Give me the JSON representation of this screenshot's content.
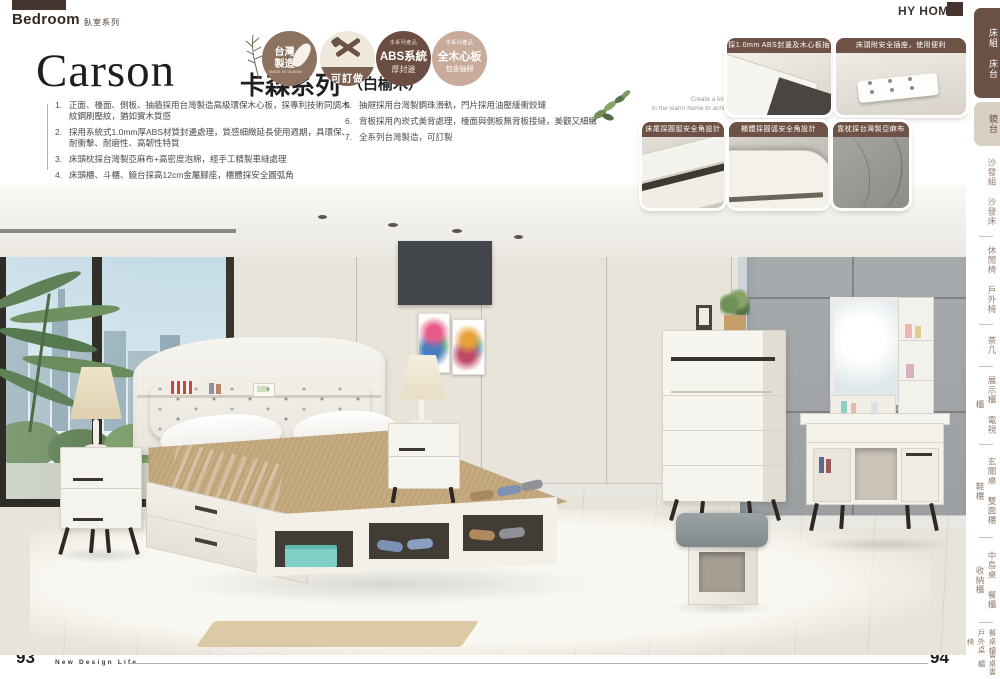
{
  "header": {
    "section_en": "Bedroom",
    "section_zh": "臥室系列",
    "brand": "HY HOME"
  },
  "series": {
    "name_en": "Carson",
    "name_zh": "卡森系列",
    "wood": "（白榆木）"
  },
  "badges": {
    "made_in_taiwan": {
      "line1": "台灣",
      "line2": "製造",
      "sub": "MADE IN TAIWAN"
    },
    "customizable": {
      "label": "可訂做"
    },
    "abs": {
      "tag": "本系列產品",
      "title": "ABS系統",
      "sub": "厚封邊"
    },
    "solid_board": {
      "tag": "本系列產品",
      "title": "全木心板",
      "sub": "包含抽屜"
    }
  },
  "features": [
    {
      "num": "1.",
      "text": "正面、檯面、側板、抽牆採用台灣製造高級環保木心板，採專利技術同調木紋鋼刷壓紋，猶如實木質感"
    },
    {
      "num": "2.",
      "text": "採用系統式1.0mm厚ABS材質封邊處理，質感細緻延長使用週期，具環保、耐衝擊、耐磨性、高韌性特質"
    },
    {
      "num": "3.",
      "text": "床頭枕採台灣製亞麻布+高密度泡棉，經手工精製車縫處理"
    },
    {
      "num": "4.",
      "text": "床頭櫃、斗櫃、鏡台採高12cm金屬腳座，櫃體採安全圓弧角"
    },
    {
      "num": "5.",
      "text": "抽屜採用台灣製鋼珠滑軌，門片採用油壓緩衝鉸鏈"
    },
    {
      "num": "6.",
      "text": "背板採用內崁式美背處理，檯面與側板無背板接縫，美觀又細緻"
    },
    {
      "num": "7.",
      "text": "全系列台灣製造，可訂製"
    }
  ],
  "tagline": {
    "line1": "Create a kind of peace and harmoniousness",
    "line2": "in the warm home to achieve the combination with nature."
  },
  "detail_photos": [
    {
      "caption": "採1.0mm ABS封邊及木心板抽屜"
    },
    {
      "caption": "床頭附安全插座，使用便利"
    },
    {
      "caption": "床尾採圓弧安全角設計"
    },
    {
      "caption": "櫃體採圓弧安全角設計"
    },
    {
      "caption": "靠枕採台灣製亞麻布"
    }
  ],
  "sidebar": {
    "items": [
      {
        "label": "床組 床台",
        "active": true
      },
      {
        "label": "鏡台",
        "active": false
      },
      {
        "label": "沙發組 沙發床",
        "active": false
      },
      {
        "label": "休閒椅 戶外椅",
        "active": false
      },
      {
        "label": "茶几",
        "active": false
      },
      {
        "label": "展示櫃 電視櫃",
        "active": false
      },
      {
        "label": "玄關桌 雙面櫃 鞋櫃",
        "active": false
      },
      {
        "label": "中島桌 餐櫃 收納櫃",
        "active": false
      },
      {
        "label": "餐桌椅 戶外桌椅",
        "active": false
      },
      {
        "label": "書桌書櫃",
        "active": false
      }
    ]
  },
  "footer": {
    "page_left": "93",
    "slogan": "New Design Life",
    "page_right": "94"
  },
  "colors": {
    "accent_brown": "#6E5246",
    "badge_dark": "#6B4D41",
    "badge_tan": "#C9AB9B",
    "sidebar_active": "#6B5146"
  }
}
